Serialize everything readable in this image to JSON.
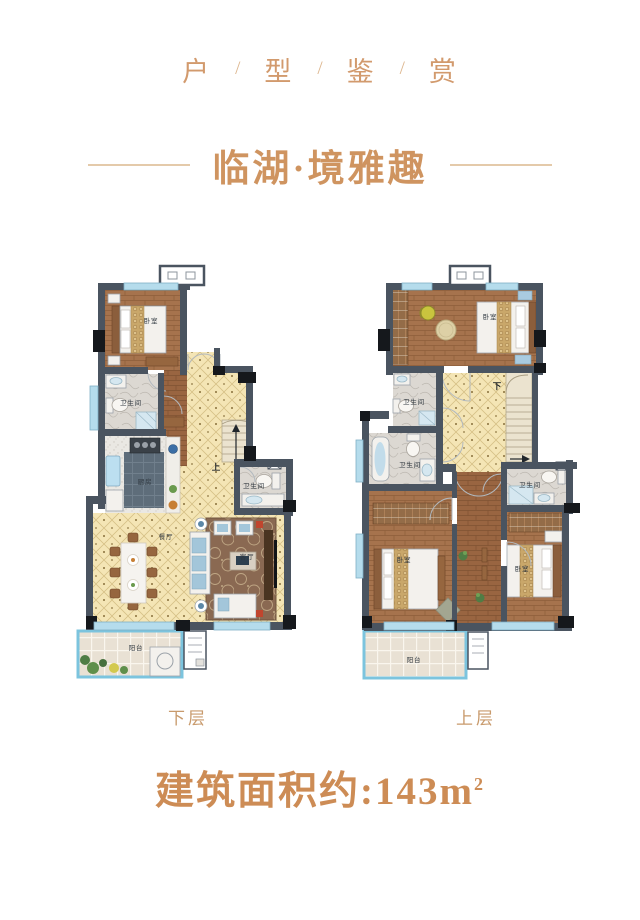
{
  "header": {
    "chars": [
      "户",
      "型",
      "鉴",
      "赏"
    ],
    "separator": "/"
  },
  "title": {
    "text": "临湖·境雅趣"
  },
  "plans": {
    "lower": {
      "label": "下层",
      "rooms": {
        "bedroom": "卧室",
        "bathroom1": "卫生间",
        "kitchen": "厨房",
        "dining": "餐厅",
        "living": "客厅",
        "bathroom2": "卫生间",
        "balcony": "阳台"
      },
      "stair_direction": "上"
    },
    "upper": {
      "label": "上层",
      "rooms": {
        "bedroom_master": "卧室",
        "bathroom1": "卫生间",
        "bathroom2": "卫生间",
        "bathroom3": "卫生间",
        "bedroom_left": "卧室",
        "bedroom_right": "卧室",
        "balcony": "阳台"
      },
      "stair_direction": "下"
    }
  },
  "area": {
    "label": "建筑面积约:",
    "value": "143m",
    "superscript": "2"
  },
  "colors": {
    "header_text": "#d29a6d",
    "title_text": "#cf9460",
    "floor_label_text": "#c89a6c",
    "area_text": "#cd8c55",
    "wall": "#4a5460",
    "window": "#b5dcec",
    "wood_floor": "#a6734d",
    "tile_floor": "#f4e5b5",
    "marble_floor": "#dcd8d2",
    "kitchen_tile": "#5e6d7a",
    "balcony_glass": "#7cc4de"
  }
}
